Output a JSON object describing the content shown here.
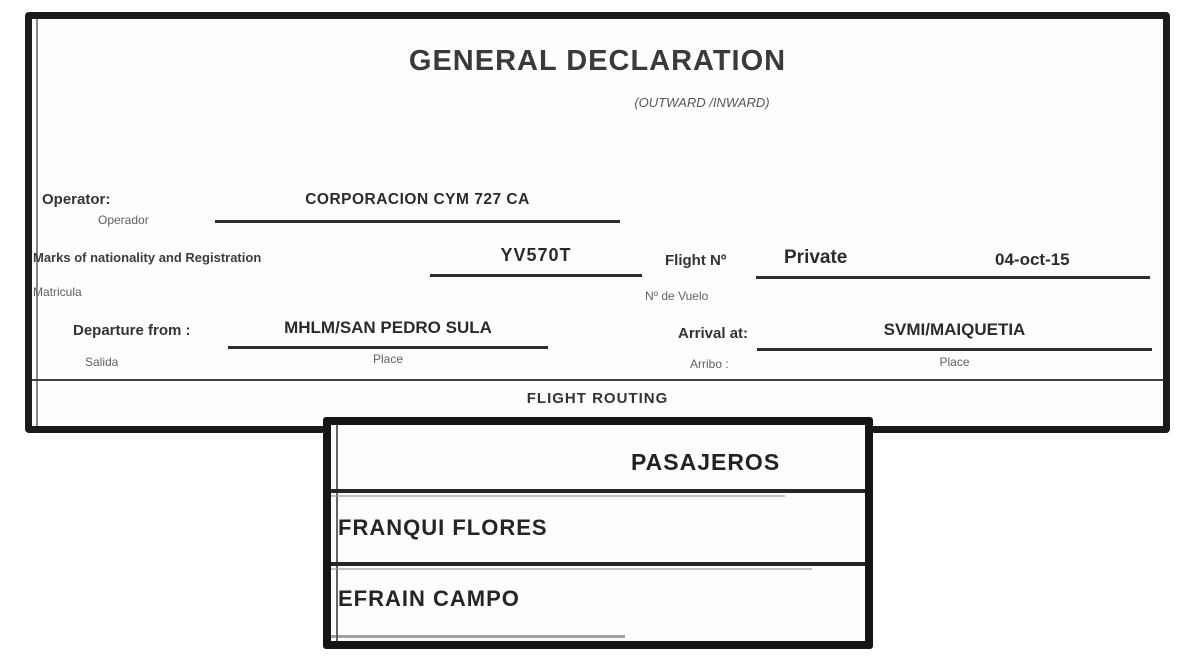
{
  "document": {
    "title": "GENERAL DECLARATION",
    "subtitle": "(OUTWARD /INWARD)",
    "operator": {
      "label": "Operator:",
      "sublabel": "Operador",
      "value": "CORPORACION CYM 727 CA"
    },
    "registration": {
      "label": "Marks of nationality and Registration",
      "sublabel": "Matricula",
      "value": "YV570T"
    },
    "flight": {
      "label": "Flight Nº",
      "sublabel": "Nº de Vuelo",
      "value": "Private",
      "date": "04-oct-15"
    },
    "departure": {
      "label": "Departure from :",
      "sublabel": "Salida",
      "value": "MHLM/SAN PEDRO SULA",
      "place_label": "Place"
    },
    "arrival": {
      "label": "Arrival at:",
      "sublabel": "Arribo :",
      "value": "SVMI/MAIQUETIA",
      "place_label": "Place"
    },
    "section_header": "FLIGHT ROUTING"
  },
  "passengers_box": {
    "header": "PASAJEROS",
    "rows": [
      "FRANQUI FLORES",
      "EFRAIN CAMPO"
    ]
  },
  "colors": {
    "border": "#1b1b1b",
    "text": "#2f2f2f",
    "muted": "#5f5f5f"
  }
}
